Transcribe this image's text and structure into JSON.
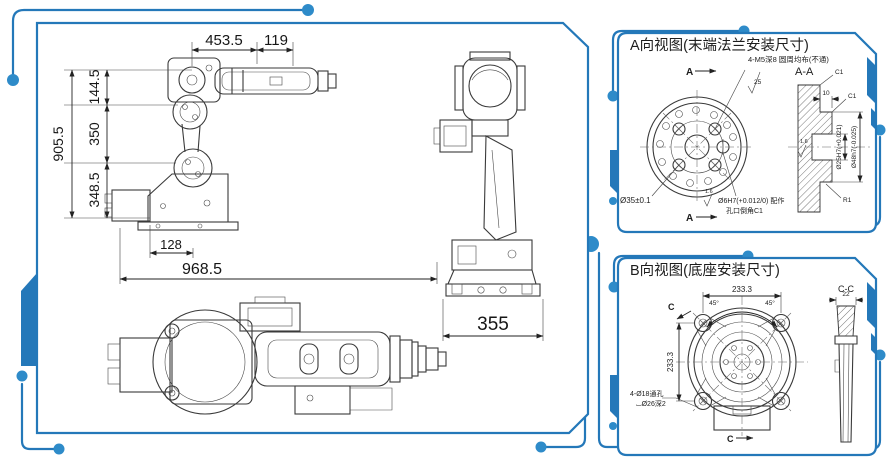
{
  "colors": {
    "accent": "#2478b9",
    "dot": "#2e8bc9",
    "drawing_line": "#3a3a3a",
    "text": "#1d1d1d",
    "background": "#ffffff"
  },
  "main_view": {
    "dims": {
      "wrist_height": "144.5",
      "forearm_reach": "453.5",
      "wrist_ext": "119",
      "total_height": "905.5",
      "upper_arm": "350",
      "shoulder_height": "348.5",
      "base_offset": "128",
      "total_reach": "968.5",
      "base_width": "355"
    }
  },
  "panel_a": {
    "title": "A向视图(末端法兰安装尺寸)",
    "view_arrow": "A",
    "section_title": "A-A",
    "labels": {
      "bolt_pattern": "4-M5深8 圆周均布(不通)",
      "finish_top": "25",
      "pitch_circle": "Ø35±0.1",
      "chamfer_a": "C1",
      "chamfer_b": "C1",
      "spigot_depth": "10",
      "finish_bore": "1.6",
      "bore": "Ø25H7(+0.021)",
      "spigot": "Ø48h7(-0.025)",
      "fillet": "R1",
      "finish_pin": "1.6",
      "pin_hole": "Ø6H7(+0.012/0) 配作",
      "chamfer_note": "孔口倒角C1"
    }
  },
  "panel_b": {
    "title": "B向视图(底座安装尺寸)",
    "view_arrow": "C",
    "section_title": "C-C",
    "labels": {
      "hole_spacing_h": "233.3",
      "hole_spacing_v": "233.3",
      "angle_left": "45°",
      "angle_right": "45°",
      "holes": "4-Ø18通孔",
      "counterbore": "⌴Ø26深2",
      "section_width": "22"
    }
  }
}
